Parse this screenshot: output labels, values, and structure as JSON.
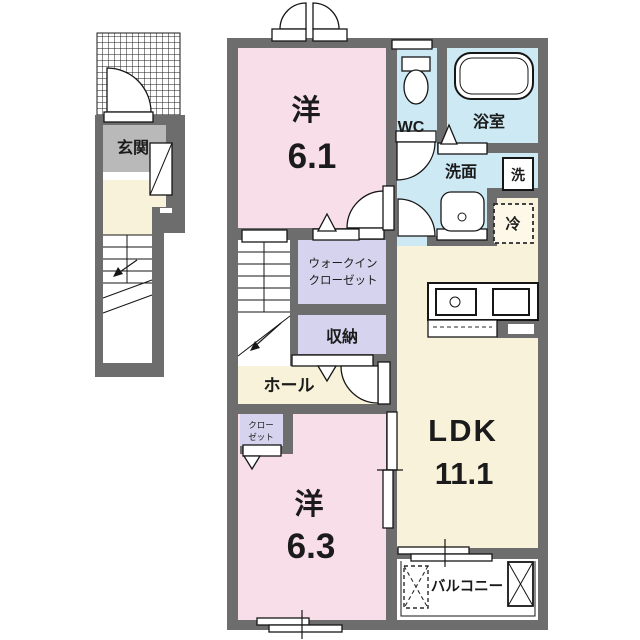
{
  "plan_title": "2F floor plan (apartment unit)",
  "rooms": {
    "entrance": {
      "label": "玄関"
    },
    "bedroom_6_1": {
      "label": "洋",
      "size": "6.1"
    },
    "wc": {
      "label": "WC"
    },
    "bathroom": {
      "label": "浴室"
    },
    "washroom": {
      "label": "洗面"
    },
    "walk_in_closet": {
      "line1": "ウォークイン",
      "line2": "クローゼット"
    },
    "storage": {
      "label": "収納"
    },
    "hall": {
      "label": "ホール"
    },
    "closet": {
      "line1": "クロー",
      "line2": "ゼット"
    },
    "bedroom_6_3": {
      "label": "洋",
      "size": "6.3"
    },
    "ldk": {
      "label": "LDK",
      "size": "11.1"
    },
    "balcony": {
      "label": "バルコニー"
    }
  },
  "fixtures": {
    "washer_label": "洗",
    "fridge_label": "冷"
  },
  "colors": {
    "wall": "#6d6d6d",
    "western_room": "#f8dee9",
    "wet_area": "#cde9f4",
    "ldk_floor": "#f9f2da",
    "closet_floor": "#d5d3ed",
    "entrance_floor": "#b9b9b9",
    "line": "#161616",
    "background": "#ffffff"
  }
}
